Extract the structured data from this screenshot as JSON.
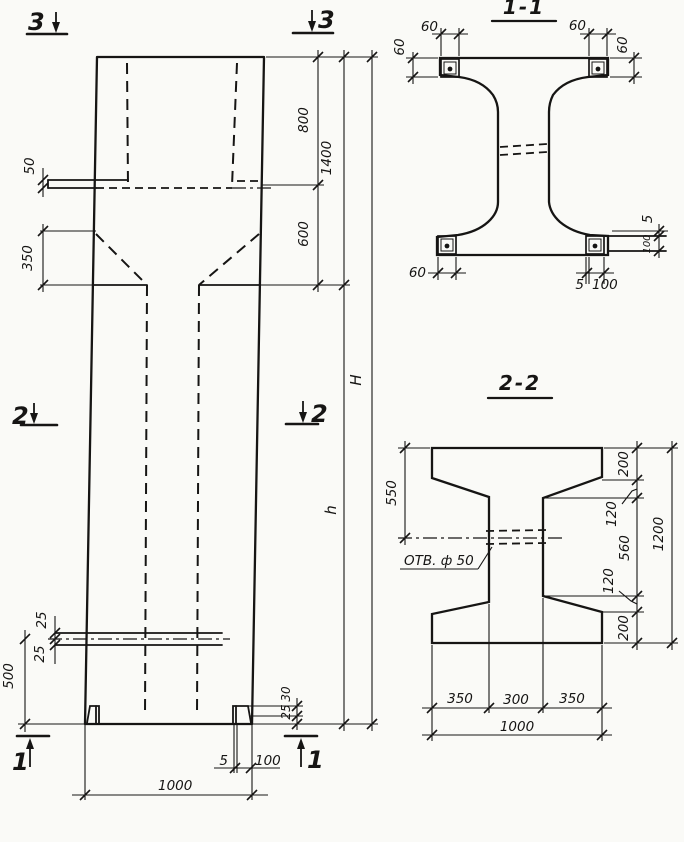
{
  "page": {
    "paper_color": "#fafaf7",
    "ink_color": "#161514",
    "kind": "structural column working drawing"
  },
  "elevation": {
    "markers": {
      "s3": "3",
      "s2": "2",
      "s1": "1"
    },
    "dims": {
      "ledge": "50",
      "taper": "350",
      "top": "800",
      "top_total": "1400",
      "neck": "600",
      "height_total": "H",
      "height_shaft": "h",
      "hole_up": "25",
      "hole_dn": "25",
      "hole_bottom": "500",
      "foot_a": "30",
      "foot_b": "25",
      "plate_t": "5",
      "plate_w": "100",
      "width": "1000"
    }
  },
  "section11": {
    "title": "1-1",
    "dims": {
      "tl_w": "60",
      "tl_h": "60",
      "tr_w": "60",
      "tr_h": "60",
      "bl": "60",
      "bb_t": "5",
      "bb_w": "100",
      "r_t": "5",
      "r_w": "100"
    }
  },
  "section22": {
    "title": "2-2",
    "hole": "ОТВ. ф 50",
    "dims": {
      "to_hole": "550",
      "f_top": "200",
      "h_top": "120",
      "web": "560",
      "h_bot": "120",
      "f_bot": "200",
      "height": "1200",
      "b_l": "350",
      "b_m": "300",
      "b_r": "350",
      "width": "1000"
    }
  }
}
